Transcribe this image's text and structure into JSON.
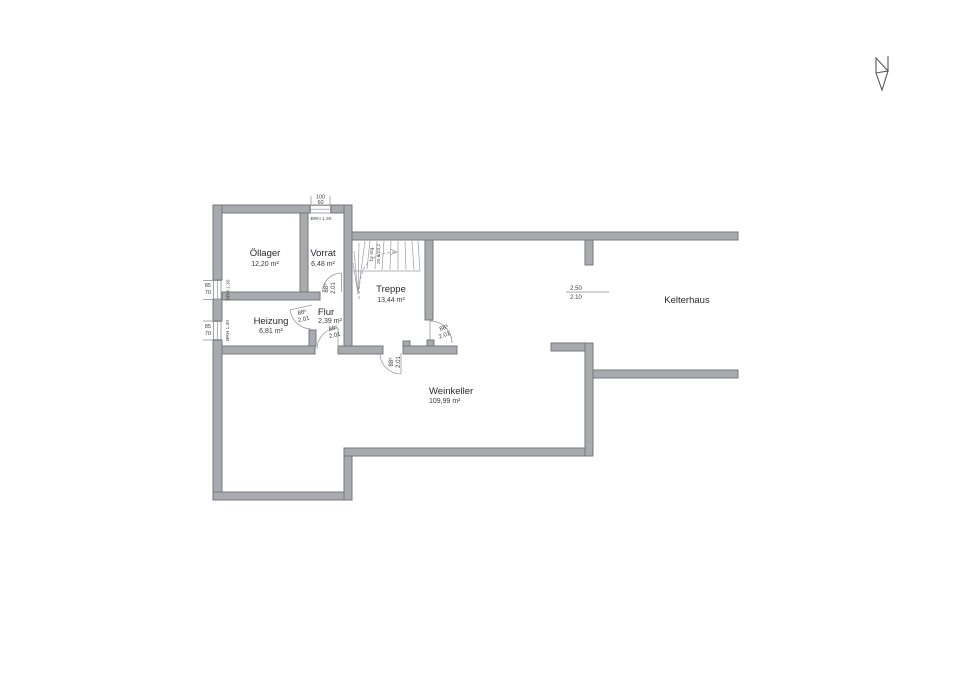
{
  "rooms": [
    {
      "name": "Öllager",
      "area": "12,20 m²"
    },
    {
      "name": "Vorrat",
      "area": "6,48 m²"
    },
    {
      "name": "Treppe",
      "area": "13,44 m²"
    },
    {
      "name": "Flur",
      "area": "2,39 m²"
    },
    {
      "name": "Heizung",
      "area": "6,81 m²"
    },
    {
      "name": "Weinkeller",
      "area": "109,99 m²"
    },
    {
      "name": "Kelterhaus",
      "area": ""
    }
  ],
  "door": {
    "width": "88⁵",
    "height": "2.01"
  },
  "opening": {
    "width": "2.50",
    "height": "2.10"
  },
  "windows": {
    "left_top": {
      "w": "85",
      "h": "70",
      "brh": "BRH 1.30"
    },
    "left_bottom": {
      "w": "85",
      "h": "70",
      "brh": "BRH 1.30"
    },
    "top": {
      "w": "100",
      "h": "60",
      "brh": "BRH 1.30"
    }
  },
  "stairs": {
    "count": "13 Stg.",
    "dim": "20,6/23,2"
  },
  "colors": {
    "wall_fill": "#a9aaae",
    "wall_stroke": "#77787c",
    "annotation_line": "#8b8c90",
    "text": "#3a3a3c",
    "background": "#ffffff"
  }
}
